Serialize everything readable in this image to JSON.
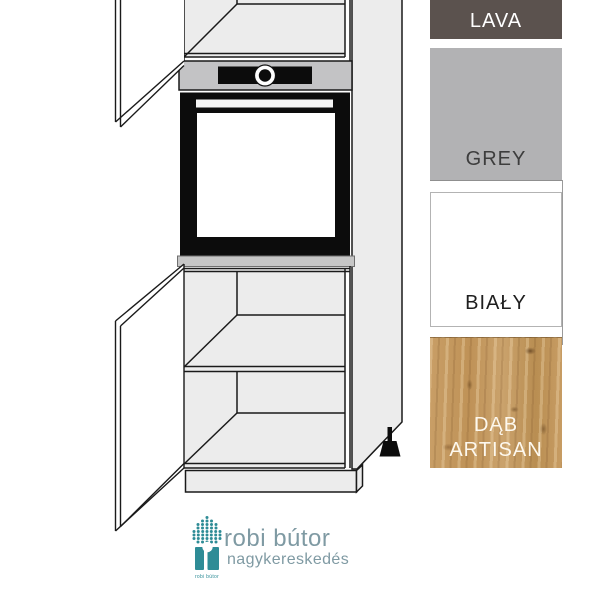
{
  "swatches": {
    "items": [
      {
        "label": "LAVA",
        "color": "#5b524e",
        "label_color": "#ffffff"
      },
      {
        "label": "GREY",
        "color": "#b2b2b4",
        "label_color": "#3d3d3d"
      },
      {
        "label": "BIAŁY",
        "color": "#ffffff",
        "label_color": "#1f1f1f"
      },
      {
        "label": "DĄB ARTISAN",
        "color": "#c49a62",
        "label_color": "#fdf8ee"
      }
    ]
  },
  "logo": {
    "title": "robi bútor",
    "subtitle": "nagykereskedés",
    "icon_caption": "robi bútor",
    "icon_color": "#2e8c96",
    "text_color": "#7f9aa3"
  }
}
